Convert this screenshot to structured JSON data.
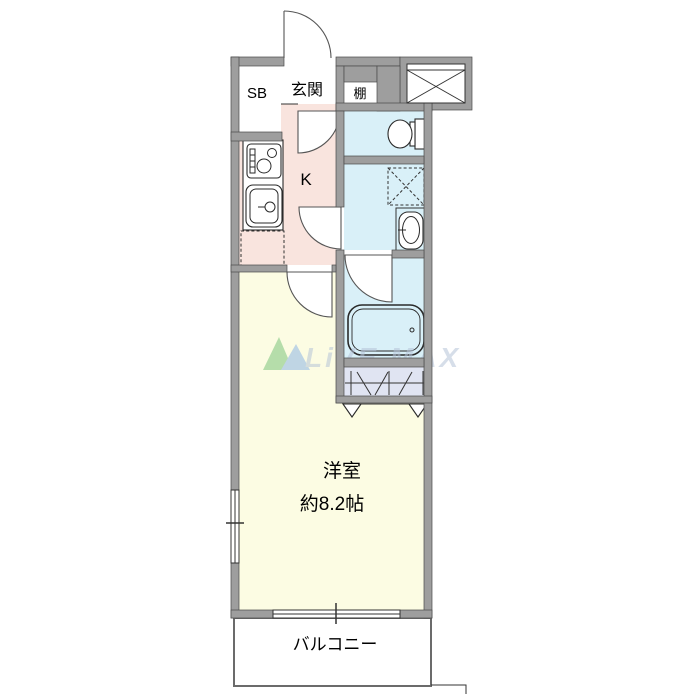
{
  "floorplan": {
    "labels": {
      "shoe_box": "SB",
      "entrance": "玄関",
      "shelf": "棚",
      "kitchen": "K",
      "main_room_name": "洋室",
      "main_room_size": "約8.2帖",
      "balcony": "バルコニー"
    },
    "watermark": {
      "text": "LiVE MAX"
    },
    "colors": {
      "wall": "#9e9e9e",
      "kitchen": "#f9e4de",
      "wet_area": "#d9f0f8",
      "closet": "#e0e4f2",
      "main_room": "#fcfce3",
      "wm_text": "#b6c4d8",
      "wm_green": "#7cc57c",
      "wm_blue": "#8fb6e6"
    }
  }
}
